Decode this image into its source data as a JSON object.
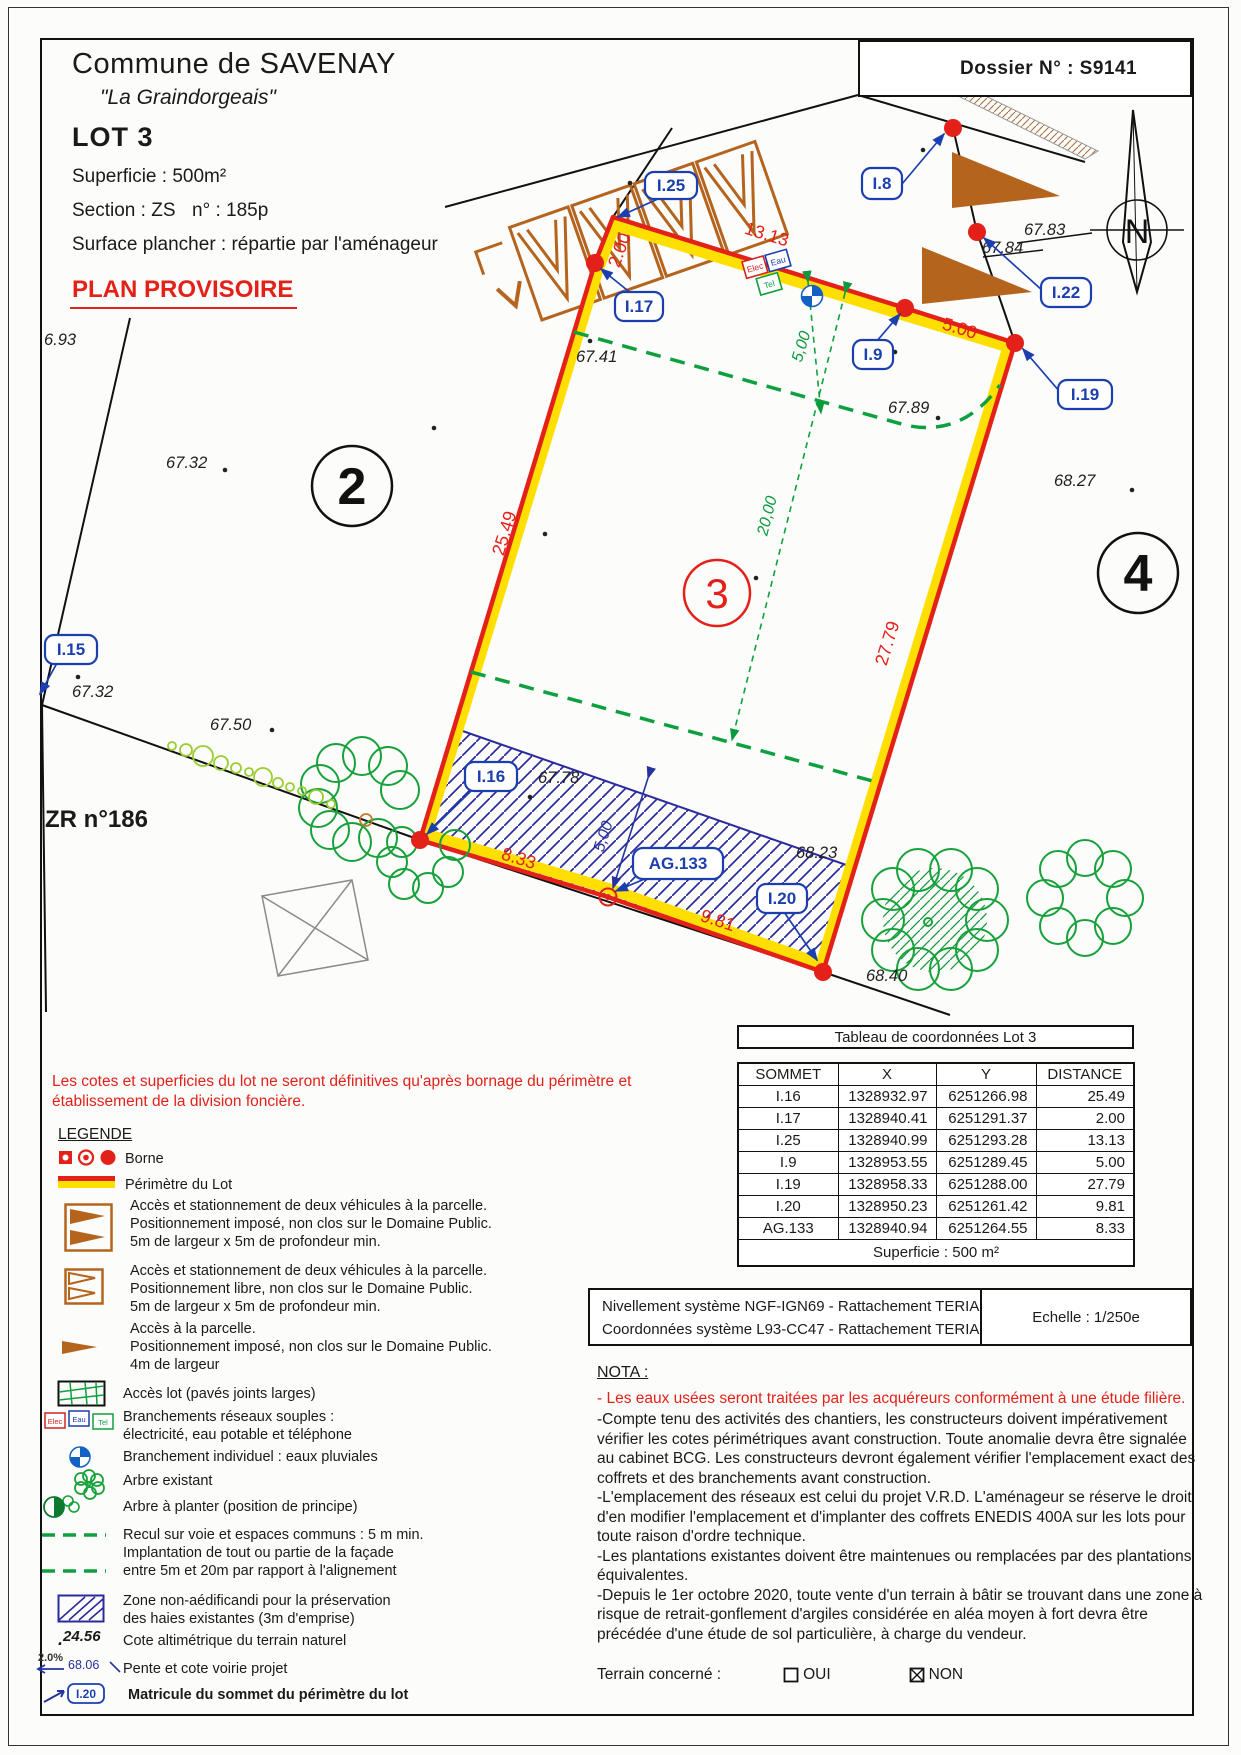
{
  "header": {
    "commune": "Commune de SAVENAY",
    "lieu_dit": "\"La Graindorgeais\"",
    "lot": "LOT 3",
    "superficie": "Superficie :  500m²",
    "section": "Section : ZS",
    "numero": "n° : 185p",
    "surface_plancher": "Surface plancher : répartie par l'aménageur",
    "plan_provisoire": "PLAN PROVISOIRE",
    "dossier": "Dossier N° : S9141"
  },
  "plan": {
    "north_letter": "N",
    "zone_label": "ZR n°186",
    "parcel_2": "2",
    "parcel_3": "3",
    "parcel_4": "4",
    "vertices": {
      "i15": "I.15",
      "i16": "I.16",
      "i17": "I.17",
      "i25": "I.25",
      "i8": "I.8",
      "i9": "I.9",
      "i19": "I.19",
      "i22": "I.22",
      "i20": "I.20",
      "ag133": "AG.133"
    },
    "dims": {
      "d_2_00": "2.00",
      "d_13_13": "13.13",
      "d_5_00": "5.00",
      "d_27_79": "27.79",
      "d_25_49": "25.49",
      "d_8_33": "8.33",
      "d_9_81": "9.81"
    },
    "green_dims": {
      "recul_5": "5,00",
      "depth_20": "20,00",
      "haie_5": "5,00"
    },
    "elevations": {
      "e1": "6.93",
      "e2": "67.32",
      "e3": "67.32",
      "e4": "67.50",
      "e5": "67.41",
      "e6": "67.89",
      "e7": "67.83",
      "e8": "67.84",
      "e9": "68.27",
      "e10": "67.78",
      "e11": "68.23",
      "e12": "68.40"
    },
    "utilities": {
      "elec": "Elec",
      "eau": "Eau",
      "tel": "Tel"
    }
  },
  "table": {
    "title": "Tableau de coordonnées Lot 3",
    "headers": [
      "SOMMET",
      "X",
      "Y",
      "DISTANCE"
    ],
    "rows": [
      [
        "I.16",
        "1328932.97",
        "6251266.98",
        "25.49"
      ],
      [
        "I.17",
        "1328940.41",
        "6251291.37",
        "2.00"
      ],
      [
        "I.25",
        "1328940.99",
        "6251293.28",
        "13.13"
      ],
      [
        "I.9",
        "1328953.55",
        "6251289.45",
        "5.00"
      ],
      [
        "I.19",
        "1328958.33",
        "6251288.00",
        "27.79"
      ],
      [
        "I.20",
        "1328950.23",
        "6251261.42",
        "9.81"
      ],
      [
        "AG.133",
        "1328940.94",
        "6251264.55",
        "8.33"
      ]
    ],
    "footer": "Superficie : 500 m²"
  },
  "survey": {
    "line1": "Nivellement système NGF-IGN69 - Rattachement TERIA",
    "line2": "Coordonnées système L93-CC47  - Rattachement TERIA",
    "scale": "Echelle : 1/250e"
  },
  "disclaimer": {
    "line1": "Les cotes et superficies du lot ne seront définitives qu'après bornage du périmètre et",
    "line2": "établissement de la division foncière."
  },
  "legend": {
    "title": "LEGENDE",
    "borne": "Borne",
    "perimetre": "Périmètre du Lot",
    "acces_impose": [
      "Accès et stationnement de deux véhicules à la parcelle.",
      "Positionnement imposé, non clos sur le Domaine Public.",
      "5m de largeur x 5m de profondeur min."
    ],
    "acces_libre": [
      "Accès et stationnement de deux véhicules à la parcelle.",
      "Positionnement libre, non clos sur le Domaine Public.",
      "5m de largeur x 5m de profondeur min."
    ],
    "acces_parcelle": [
      "Accès à la parcelle.",
      "Positionnement imposé, non clos sur le Domaine Public.",
      "4m de largeur"
    ],
    "acces_lot": "Accès lot (pavés joints larges)",
    "branchements": [
      "Branchements réseaux souples :",
      "électricité, eau potable et téléphone"
    ],
    "branchement_ep": "Branchement individuel : eaux pluviales",
    "arbre_existant": "Arbre existant",
    "arbre_planter": "Arbre à planter (position de principe)",
    "recul": [
      "Recul sur voie et espaces communs : 5 m min.",
      "Implantation de tout ou partie de la façade",
      "entre 5m et 20m par rapport à l'alignement"
    ],
    "zone_non_aedificandi": [
      "Zone non-aédificandi pour la préservation",
      "des haies existantes (3m d'emprise)"
    ],
    "cote_value": "24.56",
    "cote_label": "Cote altimétrique du terrain naturel",
    "pente_pct": "2.0%",
    "pente_value": "68.06",
    "pente_label": "Pente et cote voirie projet",
    "matricule_tag": "I.20",
    "matricule_label": "Matricule du sommet du périmètre du lot"
  },
  "nota": {
    "title": "NOTA :",
    "red_line": "- Les eaux usées seront traitées par les acquéreurs conformément à une étude filière.",
    "lines": [
      "-Compte tenu des activités des chantiers, les constructeurs doivent impérativement",
      "vérifier les cotes périmétriques avant construction. Toute anomalie devra être signalée",
      "au cabinet BCG. Les constructeurs devront également vérifier l'emplacement exact des",
      "coffrets et des branchements avant construction.",
      "-L'emplacement des réseaux est celui du projet V.R.D. L'aménageur se réserve le droit",
      "d'en modifier l'emplacement et d'implanter des coffrets ENEDIS 400A sur les lots pour",
      "toute raison d'ordre technique.",
      "-Les plantations existantes doivent être maintenues ou remplacées par des plantations",
      "équivalentes.",
      "-Depuis le 1er octobre 2020, toute vente d'un terrain à bâtir se trouvant dans une zone à",
      "risque de retrait-gonflement d'argiles considérée en aléa moyen à fort devra être",
      "précédée d'une étude de sol particulière, à charge du vendeur."
    ],
    "terrain_label": "Terrain concerné :",
    "oui": "OUI",
    "non": "NON"
  }
}
